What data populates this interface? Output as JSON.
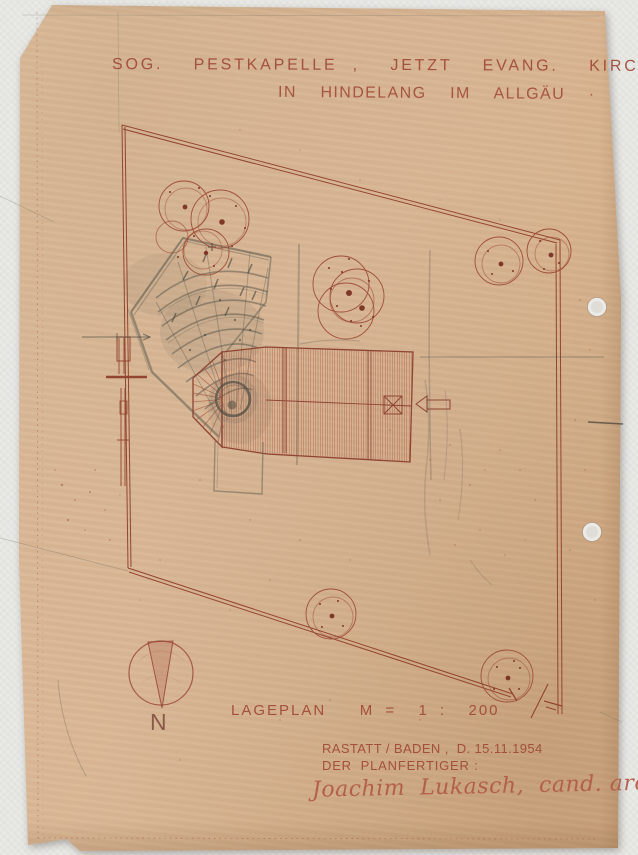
{
  "colors": {
    "paper": "#dab795",
    "background": "#e9e9e6",
    "ink": "#9b4a3a",
    "pencil": "#53534a"
  },
  "header": {
    "title_line1": "SOG.  PESTKAPELLE ,  JETZT  EVANG.  KIRCHE",
    "title_line2": "IN  HINDELANG  IM  ALLGÄU  ·"
  },
  "plan": {
    "label": "LAGEPLAN   M =  1 :  200",
    "scale": "1:200",
    "compass_label": "N"
  },
  "footer": {
    "place_date": "RASTATT / BADEN ,  D. 15.11.1954",
    "author_label": "DER  PLANFERTIGER :",
    "signature": "Joachim  Lukasch,  cand. arch."
  }
}
